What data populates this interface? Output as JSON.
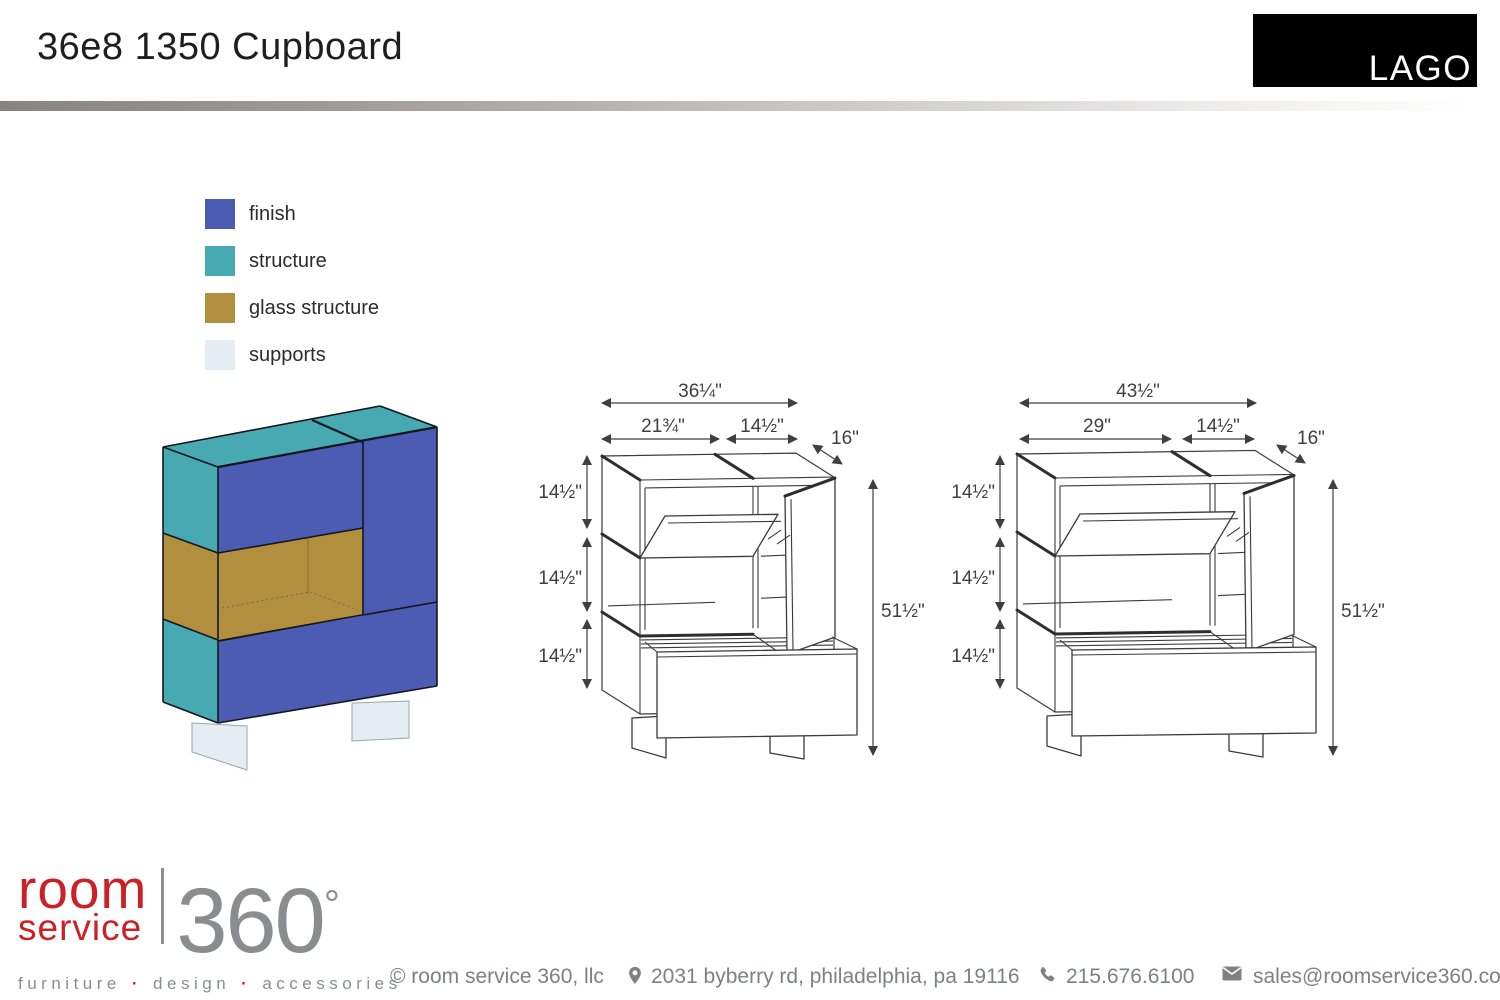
{
  "header": {
    "title": "36e8 1350 Cupboard",
    "brand": "LAGO"
  },
  "legend": {
    "items": [
      {
        "label": "finish",
        "color": "#4b5cb2"
      },
      {
        "label": "structure",
        "color": "#47aab3"
      },
      {
        "label": "glass structure",
        "color": "#b18f3e"
      },
      {
        "label": "supports",
        "color": "#e6ecf4"
      }
    ]
  },
  "drawings": {
    "left": {
      "overall_width": "36¼\"",
      "upper_left_width": "21¾\"",
      "upper_right_width": "14½\"",
      "depth": "16\"",
      "section_heights": [
        "14½\"",
        "14½\"",
        "14½\""
      ],
      "overall_height": "51½\""
    },
    "right": {
      "overall_width": "43½\"",
      "upper_left_width": "29\"",
      "upper_right_width": "14½\"",
      "depth": "16\"",
      "section_heights": [
        "14½\"",
        "14½\"",
        "14½\""
      ],
      "overall_height": "51½\""
    }
  },
  "footer": {
    "logo": {
      "word1": "room",
      "word2": "service",
      "number": "360",
      "degree": "°",
      "tagline": [
        "furniture",
        "design",
        "accessories"
      ],
      "dot": "·",
      "red": "#cb2026",
      "gray": "#8a8d8f"
    },
    "copyright": "© room service 360, llc",
    "address": "2031 byberry rd, philadelphia, pa 19116",
    "phone": "215.676.6100",
    "email": "sales@roomservice360.com"
  }
}
